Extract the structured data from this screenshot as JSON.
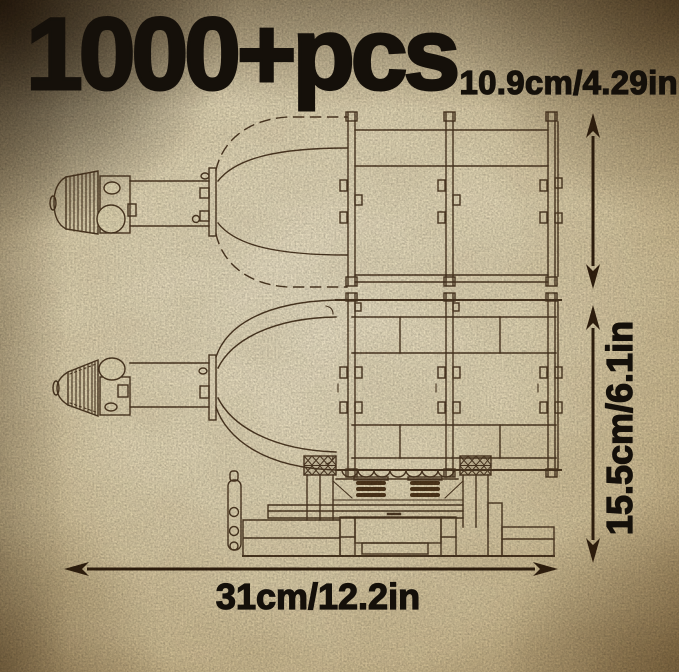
{
  "infographic": {
    "piece_count": "1000+pcs",
    "dimensions": {
      "top_view_height": "10.9cm/4.29in",
      "side_view_height": "15.5cm/6.1in",
      "length": "31cm/12.2in"
    }
  },
  "icons": {
    "top_height_arrow": "vertical-double-headed-arrow",
    "side_height_arrow": "vertical-double-headed-arrow",
    "length_arrow": "horizontal-double-headed-arrow"
  },
  "colors": {
    "paper_light": "#eee5ca",
    "paper_mid": "#d9c9a3",
    "paper_edge": "#ac9164",
    "corner_shadow": "#2a1c0c",
    "line_art": "#46311b",
    "arrow": "#32200e",
    "text": "#15100a"
  }
}
